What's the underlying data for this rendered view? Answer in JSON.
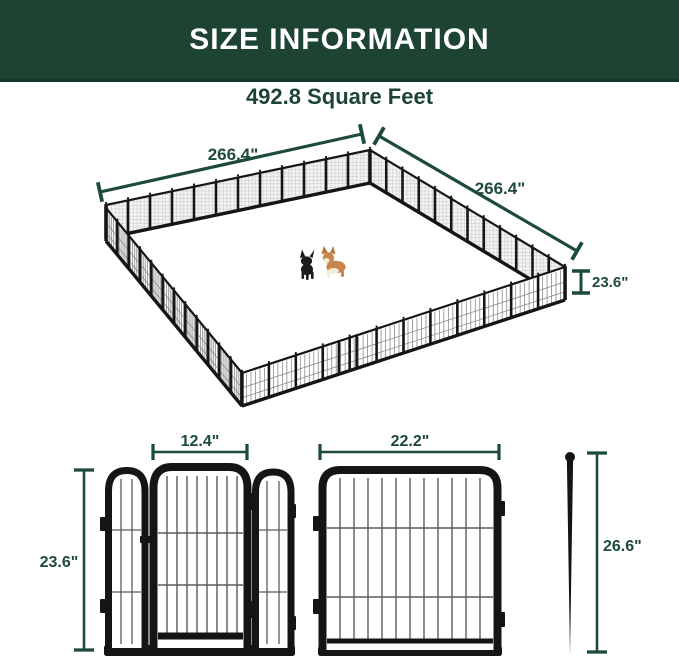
{
  "header": {
    "title": "SIZE INFORMATION"
  },
  "subtitle": "492.8 Square Feet",
  "colors": {
    "header_bg": "#1d4433",
    "dimension_green": "#1d4a3a",
    "fence_black": "#151515",
    "mesh_fill": "#f3f3f3",
    "mesh_line": "#b8b8b8",
    "bar_gray": "#5a5a5a",
    "dog_black": "#1c1c1c",
    "dog_tan": "#c9864c",
    "dog_cream": "#f6ead9"
  },
  "enclosure": {
    "panels_per_side": 12,
    "dimensions": {
      "side_left": "266.4\"",
      "side_right": "266.4\"",
      "height": "23.6\""
    }
  },
  "panel_details": {
    "door_width": "12.4\"",
    "panel_width": "22.2\"",
    "panel_height": "23.6\"",
    "stake_length": "26.6\""
  }
}
